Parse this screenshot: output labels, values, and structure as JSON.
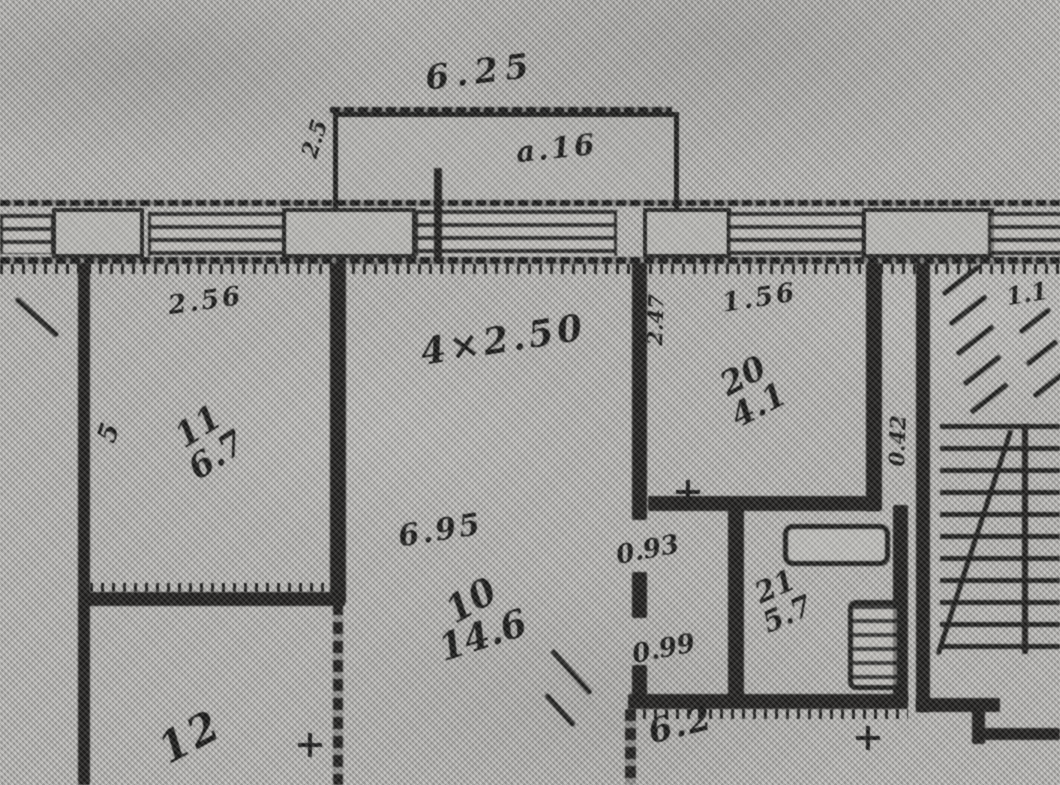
{
  "plan": {
    "kind": "scanned apartment floor plan (BTI blueprint)",
    "paper_color": "#b3b2af",
    "ink_color": "#1a1a19"
  },
  "balcony": {
    "width_dim": "6.25",
    "label": "а.16",
    "side_dim": "2.5"
  },
  "facade": {
    "window_dim": "4×2.50"
  },
  "rooms": {
    "room11": {
      "number": "11",
      "area": "6.7",
      "top_dim": "2.56",
      "side_dim": "5"
    },
    "room10": {
      "number": "10",
      "area": "14.6",
      "width_dim": "6.95"
    },
    "room20": {
      "number": "20",
      "area": "4.1",
      "top_dim": "1.56",
      "left_dim": "2.47",
      "right_dim": "0.42"
    },
    "room21": {
      "number": "21",
      "area": "5.7"
    },
    "room12": {
      "number": "12"
    },
    "room22": {
      "area": "6.2"
    }
  },
  "doors": {
    "door_a": "0.93",
    "door_b": "0.99"
  },
  "stairs": {
    "top_dim": "1.1"
  }
}
